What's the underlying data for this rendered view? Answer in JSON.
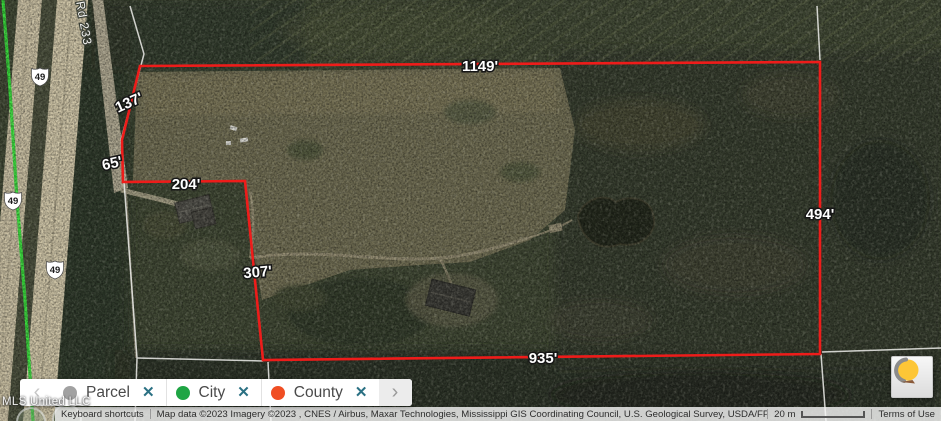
{
  "map": {
    "parcel": {
      "measurements": [
        {
          "side": "north",
          "text": "1149'"
        },
        {
          "side": "northwest-diagonal",
          "text": "137'"
        },
        {
          "side": "west-upper",
          "text": "65'"
        },
        {
          "side": "north-inner",
          "text": "204'"
        },
        {
          "side": "west-inner",
          "text": "307'"
        },
        {
          "side": "east",
          "text": "494'"
        },
        {
          "side": "south",
          "text": "935'"
        }
      ]
    },
    "roads": {
      "highway_shield": "49",
      "road_label": "Rd 233"
    },
    "watermark": "MLS United LLC"
  },
  "layers_bar": {
    "prev_label": "‹",
    "next_label": "›",
    "chips": [
      {
        "label": "Parcel",
        "color": "#a1a1a1",
        "remove": "✕"
      },
      {
        "label": "City",
        "color": "#1fa544",
        "remove": "✕"
      },
      {
        "label": "County",
        "color": "#f04e23",
        "remove": "✕"
      }
    ]
  },
  "attribution": {
    "keyboard_shortcuts": "Keyboard shortcuts",
    "map_data": "Map data ©2023 Imagery ©2023 , CNES / Airbus, Maxar Technologies, Mississippi GIS Coordinating Council, U.S. Geological Survey, USDA/FPAC/GEO",
    "scale": "20 m",
    "terms": "Terms of Use"
  },
  "colors": {
    "parcel_boundary_red": "#ee1c1a",
    "route_highlight_green": "#38e03c",
    "city_green": "#1fa544",
    "county_orange": "#f04e23",
    "parcel_gray": "#a1a1a1",
    "chip_close_teal": "#2a7083"
  }
}
